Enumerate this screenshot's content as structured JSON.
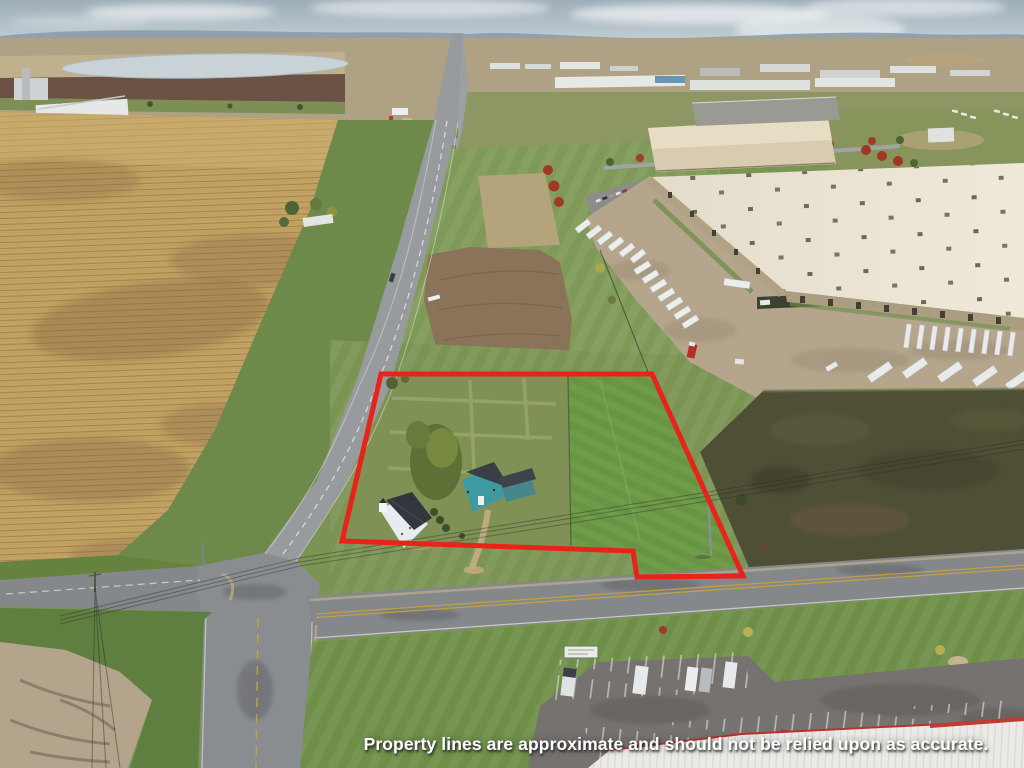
{
  "overlay": {
    "disclaimer": "Property lines are approximate and should not be relied upon as accurate."
  },
  "annotation": {
    "property_outline_color": "#e8231a",
    "outline_stroke_px": 5
  },
  "palette": {
    "sky": "#a9b6bf",
    "cornfield": "#c3a363",
    "grass": "#7b9454",
    "lawn": "#6f9c49",
    "asphalt": "#8e9194",
    "warehouse_roof": "#eae3d3",
    "teal_house": "#3f99a1",
    "white_house": "#e9ebee",
    "scrub_field": "#4f4f36",
    "disclaimer_text": "#ffffff"
  }
}
